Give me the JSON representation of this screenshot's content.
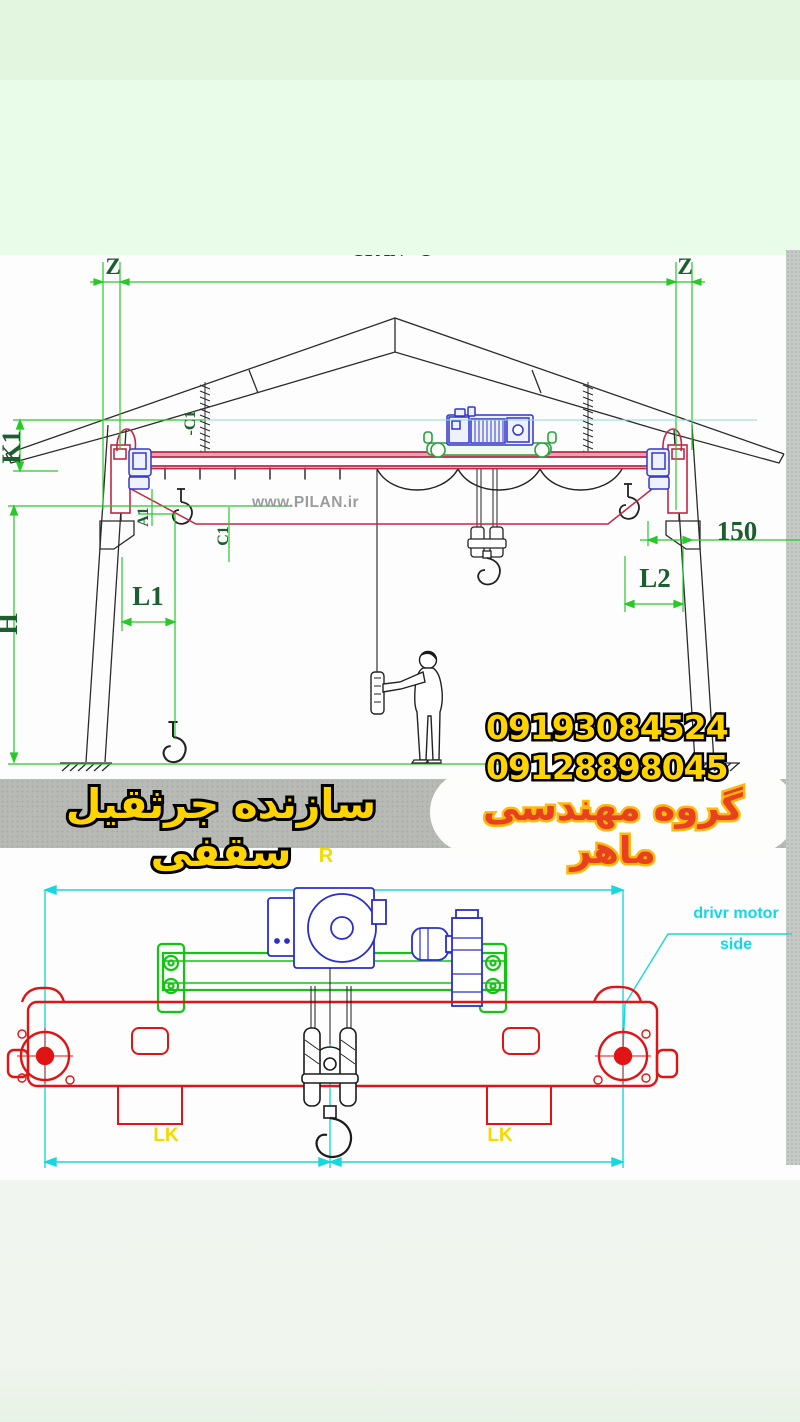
{
  "elevation_view": {
    "span_label": "SPAN - S",
    "z_left": "Z",
    "z_right": "Z",
    "labels": {
      "k1": "K1",
      "h": "H",
      "c1_top": "-C1",
      "a1": "A1",
      "c1": "C1",
      "l1": "L1",
      "l2": "L2",
      "dim150": "150"
    },
    "watermark": "www.PILAN.ir"
  },
  "end_view": {
    "labels": {
      "r": "R",
      "lk_left": "LK",
      "lk_right": "LK"
    },
    "note_line1": "drivr motor",
    "note_line2": "side"
  },
  "contact": {
    "phone1": "09193084524",
    "phone2": "09128898045",
    "banner": "سازنده جرثقیل سقفی",
    "company": "گروه مهندسی ماهر"
  },
  "colors": {
    "dimension_green": "#28c828",
    "label_green": "#1c5e2e",
    "crane_red": "#c32646",
    "end_view_red": "#e01414",
    "machine_blue": "#2a2ecb",
    "machine_green": "#13c413",
    "dimension_cyan": "#18d6de",
    "text_yellow": "#ffd400",
    "company_red": "#e8411f",
    "band_green_top": "#e3f7e0",
    "band_green": "#e8fce9",
    "ground_gray": "#b8bab6"
  }
}
